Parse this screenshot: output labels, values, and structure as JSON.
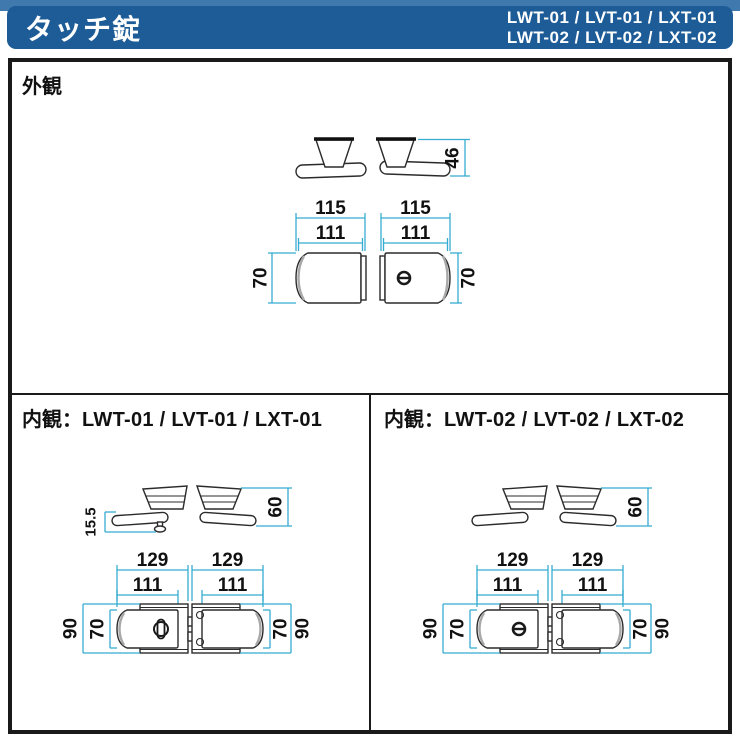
{
  "header": {
    "title": "タッチ錠",
    "models_line1": "LWT-01 / LVT-01 / LXT-01",
    "models_line2": "LWT-02 / LVT-02 / LXT-02"
  },
  "sections": {
    "exterior": {
      "title": "外観"
    },
    "interior_left": {
      "title_prefix": "内観：",
      "title_models": "LWT-01 / LVT-01 / LXT-01"
    },
    "interior_right": {
      "title_prefix": "内観：",
      "title_models": "LWT-02 / LVT-02 / LXT-02"
    }
  },
  "dims": {
    "exterior": {
      "width_outer": "115",
      "width_inner": "111",
      "height_body": "70",
      "handle_depth": "46"
    },
    "interior": {
      "width_outer": "129",
      "width_inner": "111",
      "height_plate": "90",
      "height_body": "70",
      "handle_depth": "60",
      "thumbturn_depth": "15.5"
    }
  },
  "colors": {
    "header_bar": "#1e5c97",
    "header_strip": "#4079ae",
    "dimension_line": "#35acd1",
    "drawing_line": "#2b2b2b",
    "frame": "#1a1a1a"
  }
}
